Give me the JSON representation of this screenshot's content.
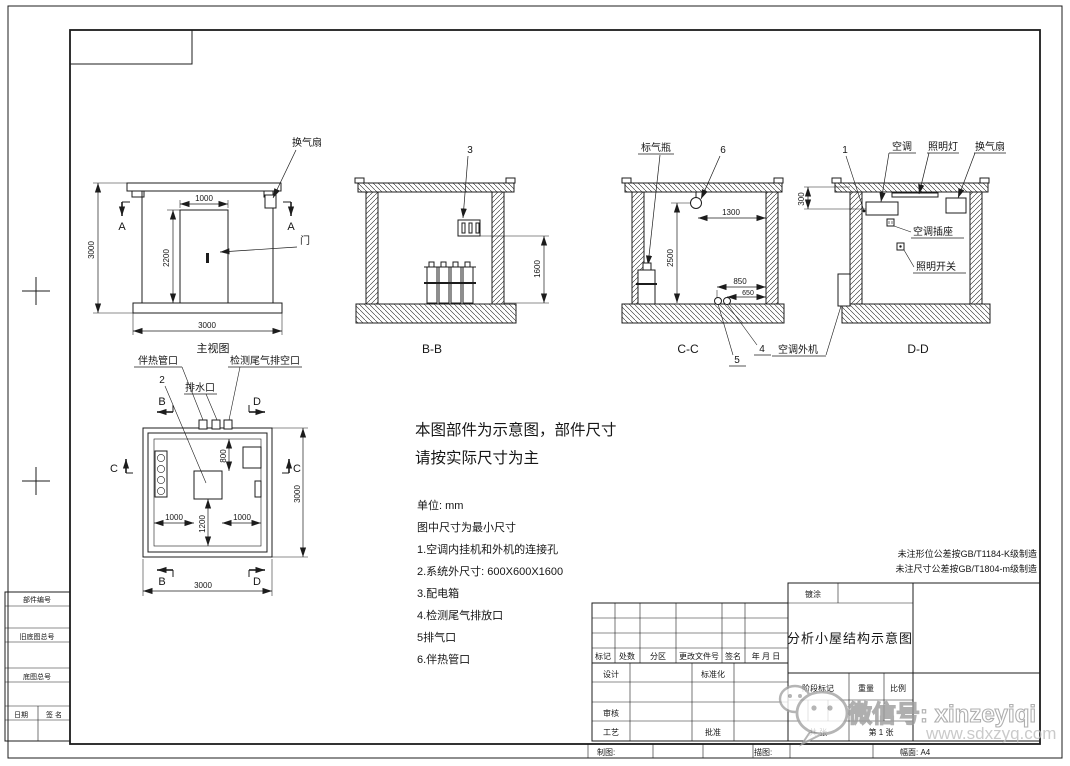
{
  "drawing": {
    "front": {
      "title": "主视图",
      "marker_a": "A",
      "label_fan": "换气扇",
      "label_door": "门",
      "dim_width": "3000",
      "dim_height": "3000",
      "dim_door_w": "1000",
      "dim_door_h": "2200"
    },
    "section_bb": {
      "title": "B-B",
      "num_3": "3",
      "dim_1600": "1600"
    },
    "section_cc": {
      "title": "C-C",
      "label_gas_bottle": "标气瓶",
      "num_6": "6",
      "num_5": "5",
      "num_4": "4",
      "dim_1300": "1300",
      "dim_2500": "2500",
      "dim_850": "850",
      "dim_650": "650",
      "label_ac_outdoor": "空调外机"
    },
    "section_dd": {
      "title": "D-D",
      "num_1": "1",
      "label_ac": "空调",
      "label_lamp": "照明灯",
      "label_fan": "换气扇",
      "label_ac_socket": "空调插座",
      "label_light_switch": "照明开关",
      "dim_300": "300"
    },
    "plan": {
      "label_heat_pipe": "伴热管口",
      "label_exhaust_vent": "检测尾气排空口",
      "label_drain": "排水口",
      "num_2": "2",
      "marker_b": "B",
      "marker_c": "C",
      "marker_d": "D",
      "dim_800": "800",
      "dim_1000_left": "1000",
      "dim_1200": "1200",
      "dim_1000_right": "1000",
      "dim_3000_side": "3000",
      "dim_3000_bottom": "3000"
    }
  },
  "statement": {
    "line1": "本图部件为示意图，部件尺寸",
    "line2": "请按实际尺寸为主"
  },
  "notes": {
    "unit": "单位: mm",
    "min_size": "图中尺寸为最小尺寸",
    "item1": "1.空调内挂机和外机的连接孔",
    "item2": "2.系统外尺寸: 600X600X1600",
    "item3": "3.配电箱",
    "item4": "4.检测尾气排放口",
    "item5": "5排气口",
    "item6": "6.伴热管口"
  },
  "tolerance_notes": {
    "line1": "未注形位公差按GB/T1184-K级制造",
    "line2": "未注尺寸公差按GB/T1804-m级制造"
  },
  "title_block": {
    "coating": "镀涂",
    "drawing_title": "分析小屋结构示意图",
    "col_mark": "标记",
    "col_count": "处数",
    "col_zone": "分区",
    "col_change_doc": "更改文件号",
    "col_sign": "签名",
    "col_date": "年 月 日",
    "row_design": "设计",
    "row_standardization": "标准化",
    "row_review": "审核",
    "row_process": "工艺",
    "row_approve": "批准",
    "stage_mark": "阶段标记",
    "weight": "重量",
    "scale": "比例",
    "sheets_total": "共 张",
    "sheet_no": "第 1 张",
    "drawn_by": "制图:",
    "traced_by": "描图:",
    "paper_size": "幅面: A4"
  },
  "side_table": {
    "part_no": "部件编号",
    "old_master_no": "旧底图总号",
    "master_no": "底图总号",
    "date": "日期",
    "sign": "签 名"
  },
  "watermark": {
    "wechat_label": "微信号: xinzeyiqi",
    "website": "www.sdxzyq.com"
  }
}
